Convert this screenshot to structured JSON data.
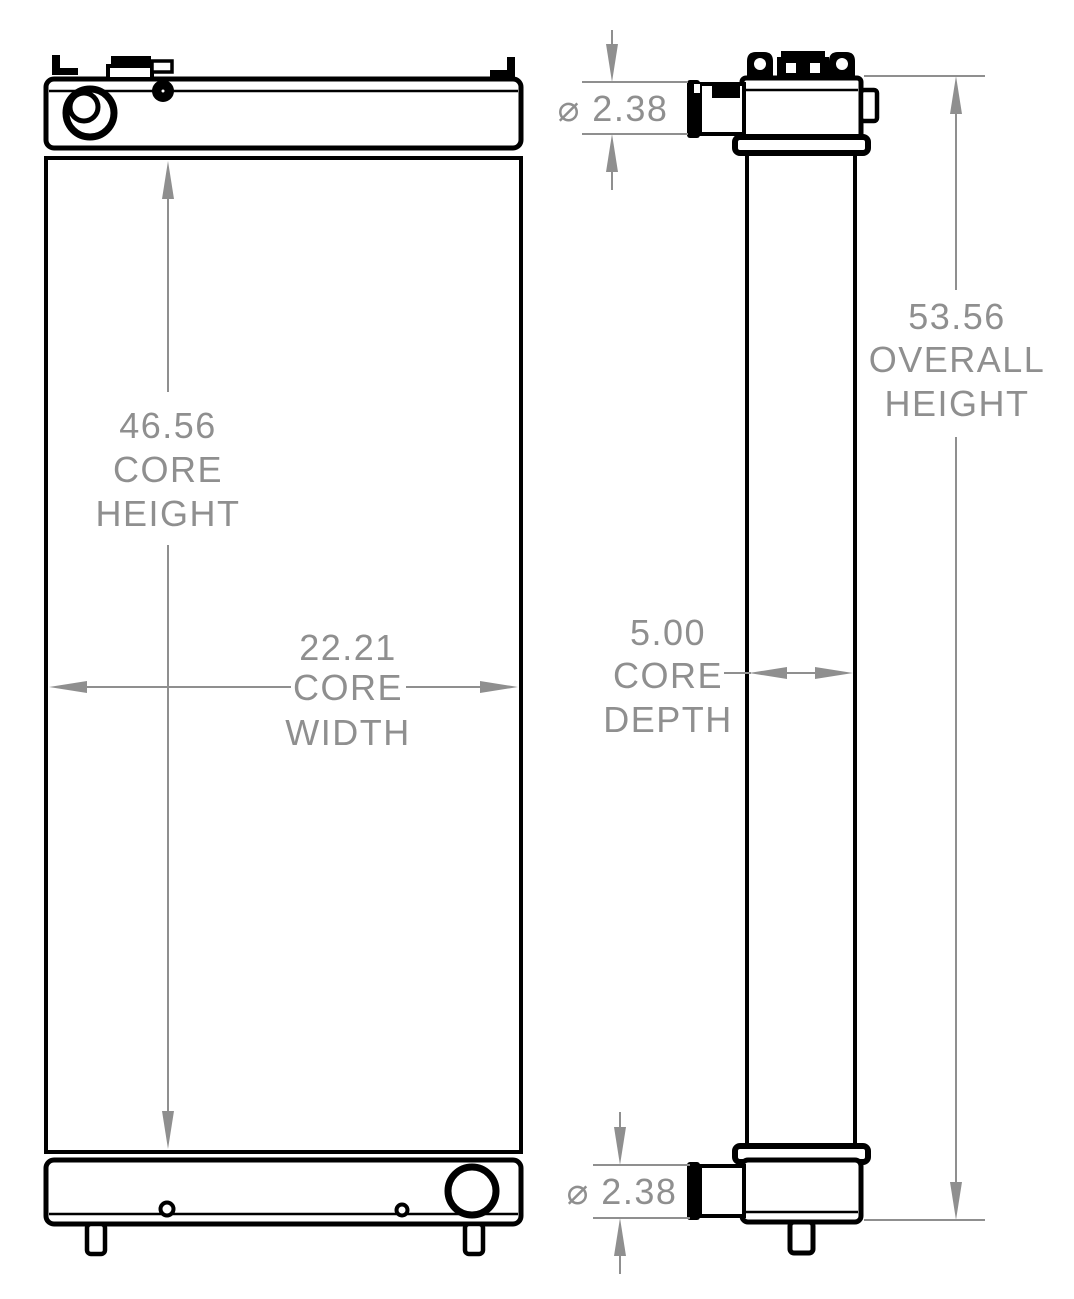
{
  "colors": {
    "outline": "#000000",
    "dimension": "#8f8f8f",
    "background": "#ffffff"
  },
  "front_view": {
    "core_height": {
      "lines": [
        "46.56",
        "CORE",
        "HEIGHT"
      ]
    },
    "core_width": {
      "lines": [
        "22.21",
        "CORE",
        "WIDTH"
      ]
    }
  },
  "side_view": {
    "overall_height": {
      "lines": [
        "53.56",
        "OVERALL",
        "HEIGHT"
      ]
    },
    "core_depth": {
      "lines": [
        "5.00",
        "CORE",
        "DEPTH"
      ]
    },
    "inlet_diameter": {
      "label": "⌀ 2.38"
    },
    "outlet_diameter": {
      "label": "⌀ 2.38"
    }
  }
}
